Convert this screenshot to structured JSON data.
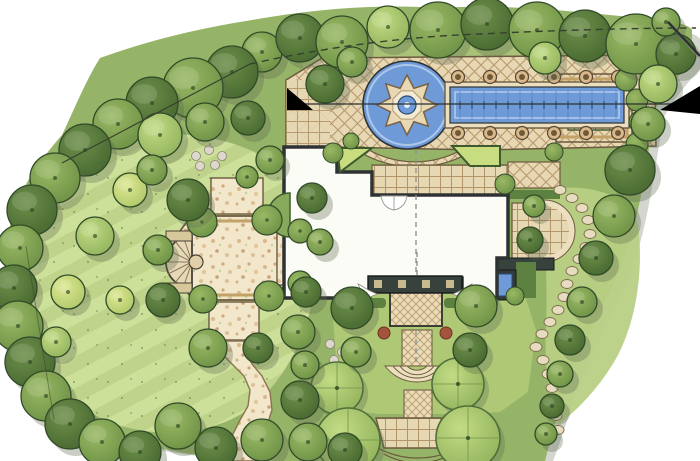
{
  "palette": {
    "paper": "#ffffff",
    "canopy_base": "#96b468",
    "canopy_shadow": "#8c937f",
    "lawn": "#bfd48a",
    "lawn_stripe": "#cde09a",
    "turf_dark": "#8fae60",
    "deck": "#e7d7b2",
    "deck_line": "#a98a5e",
    "paving_edge": "#6b5a3f",
    "gravel": "#f2e7cb",
    "water": "#6e9bd8",
    "water_deep": "#3f6cb0",
    "water_light": "#bcd2ee",
    "coping": "#ecdfc0",
    "stone": "#e8dcc0",
    "house_wall": "#2e3233",
    "house_fill": "#fcfcf7",
    "pergola": "#38423d",
    "hedge": "#5d8140",
    "hedge_dark": "#3c5a2c",
    "tree_stroke": "#314a28",
    "accent_red": "#a2543c",
    "marker": "#000000",
    "line": "#37412e"
  },
  "water": {
    "fountain": {
      "cx": 407,
      "cy": 105,
      "outer_r": 30,
      "inner_r": 18,
      "points": 8,
      "basin_r": 44
    },
    "lap_pool": {
      "x": 450,
      "y": 87,
      "w": 174,
      "h": 36,
      "jet_x1": 460,
      "jet_x2": 616,
      "jet_step": 12
    },
    "planters": {
      "x_start": 458,
      "x_step": 32,
      "count": 6,
      "y_rows": [
        77,
        133
      ],
      "r": 6.5
    },
    "spa": {
      "x": 492,
      "y": 274,
      "w": 20,
      "h": 22
    }
  },
  "planting": {
    "trees": [
      [
        262,
        52,
        20,
        "m"
      ],
      [
        300,
        38,
        24,
        "d"
      ],
      [
        342,
        42,
        26,
        "m"
      ],
      [
        388,
        27,
        21,
        "l"
      ],
      [
        438,
        30,
        28,
        "m"
      ],
      [
        487,
        24,
        26,
        "d"
      ],
      [
        537,
        30,
        28,
        "m"
      ],
      [
        585,
        36,
        26,
        "d"
      ],
      [
        636,
        44,
        30,
        "m"
      ],
      [
        676,
        54,
        20,
        "d"
      ],
      [
        666,
        22,
        14,
        "m"
      ],
      [
        232,
        72,
        26,
        "d"
      ],
      [
        193,
        88,
        30,
        "m"
      ],
      [
        152,
        103,
        26,
        "d"
      ],
      [
        118,
        124,
        25,
        "m"
      ],
      [
        85,
        150,
        26,
        "d"
      ],
      [
        55,
        178,
        25,
        "m"
      ],
      [
        32,
        210,
        25,
        "d"
      ],
      [
        20,
        248,
        23,
        "m"
      ],
      [
        14,
        288,
        23,
        "d"
      ],
      [
        18,
        326,
        25,
        "m"
      ],
      [
        30,
        362,
        25,
        "d"
      ],
      [
        46,
        396,
        25,
        "m"
      ],
      [
        70,
        424,
        25,
        "d"
      ],
      [
        102,
        442,
        23,
        "m"
      ],
      [
        140,
        452,
        21,
        "d"
      ],
      [
        160,
        135,
        22,
        "l"
      ],
      [
        205,
        122,
        19,
        "m"
      ],
      [
        248,
        118,
        17,
        "d"
      ],
      [
        130,
        190,
        17,
        "y"
      ],
      [
        95,
        236,
        19,
        "l"
      ],
      [
        68,
        292,
        17,
        "y"
      ],
      [
        56,
        342,
        15,
        "l"
      ],
      [
        152,
        170,
        15,
        "m"
      ],
      [
        120,
        300,
        14,
        "y"
      ],
      [
        188,
        200,
        21,
        "d"
      ],
      [
        158,
        250,
        15,
        "m"
      ],
      [
        163,
        300,
        17,
        "d"
      ],
      [
        208,
        348,
        19,
        "m"
      ],
      [
        258,
        348,
        15,
        "d"
      ],
      [
        298,
        332,
        17,
        "m"
      ],
      [
        312,
        198,
        15,
        "d"
      ],
      [
        320,
        242,
        13,
        "m"
      ],
      [
        306,
        292,
        15,
        "d"
      ],
      [
        270,
        160,
        14,
        "m"
      ],
      [
        178,
        426,
        23,
        "m"
      ],
      [
        216,
        448,
        21,
        "d"
      ],
      [
        262,
        440,
        21,
        "m"
      ],
      [
        300,
        400,
        19,
        "d"
      ],
      [
        308,
        442,
        19,
        "m"
      ],
      [
        345,
        450,
        17,
        "d"
      ],
      [
        352,
        308,
        21,
        "d"
      ],
      [
        476,
        306,
        21,
        "m"
      ],
      [
        356,
        352,
        15,
        "m"
      ],
      [
        470,
        350,
        17,
        "d"
      ],
      [
        305,
        365,
        14,
        "m"
      ],
      [
        658,
        84,
        19,
        "l"
      ],
      [
        648,
        124,
        17,
        "m"
      ],
      [
        630,
        170,
        25,
        "d"
      ],
      [
        614,
        216,
        21,
        "m"
      ],
      [
        596,
        258,
        17,
        "d"
      ],
      [
        582,
        302,
        15,
        "m"
      ],
      [
        570,
        340,
        15,
        "d"
      ],
      [
        560,
        374,
        13,
        "m"
      ],
      [
        552,
        406,
        12,
        "d"
      ],
      [
        546,
        434,
        11,
        "m"
      ],
      [
        325,
        84,
        19,
        "d"
      ],
      [
        352,
        62,
        15,
        "m"
      ],
      [
        530,
        240,
        13,
        "d"
      ],
      [
        534,
        206,
        11,
        "m"
      ],
      [
        545,
        58,
        16,
        "l"
      ]
    ],
    "shrub_balls": [
      [
        626,
        80,
        11
      ],
      [
        637,
        100,
        11
      ],
      [
        640,
        122,
        11
      ],
      [
        637,
        144,
        11
      ],
      [
        628,
        163,
        10
      ],
      [
        333,
        153,
        10
      ],
      [
        351,
        141,
        8
      ],
      [
        554,
        152,
        9
      ],
      [
        505,
        184,
        10
      ],
      [
        515,
        296,
        9
      ]
    ],
    "clipped_trees": [
      [
        202,
        222,
        15
      ],
      [
        267,
        220,
        15
      ],
      [
        269,
        296,
        15
      ],
      [
        203,
        299,
        14
      ],
      [
        247,
        177,
        11
      ],
      [
        300,
        231,
        12
      ],
      [
        300,
        283,
        12
      ]
    ],
    "big_clipped_shrubs": [
      [
        337,
        388,
        26
      ],
      [
        348,
        440,
        32
      ],
      [
        458,
        384,
        26
      ],
      [
        468,
        438,
        32
      ]
    ]
  },
  "paths": {
    "stepping_stones_a": [
      [
        560,
        190
      ],
      [
        572,
        198
      ],
      [
        582,
        208
      ],
      [
        588,
        220
      ],
      [
        590,
        234
      ],
      [
        586,
        247
      ],
      [
        579,
        259
      ],
      [
        572,
        271
      ],
      [
        567,
        284
      ],
      [
        564,
        297
      ],
      [
        558,
        310
      ],
      [
        550,
        322
      ],
      [
        542,
        334
      ],
      [
        536,
        347
      ]
    ],
    "stepping_stones_b": [
      [
        543,
        360
      ],
      [
        548,
        374
      ],
      [
        552,
        388
      ],
      [
        554,
        402
      ],
      [
        556,
        416
      ],
      [
        558,
        430
      ]
    ],
    "pebbles": [
      [
        196,
        156
      ],
      [
        209,
        150
      ],
      [
        222,
        156
      ],
      [
        215,
        165
      ],
      [
        200,
        166
      ],
      [
        330,
        344
      ],
      [
        342,
        352
      ],
      [
        334,
        360
      ]
    ]
  },
  "markers": {
    "section_left_triangle": "287,88 313,110 287,110",
    "section_right_triangle": "700,86 700,114 660,110"
  }
}
